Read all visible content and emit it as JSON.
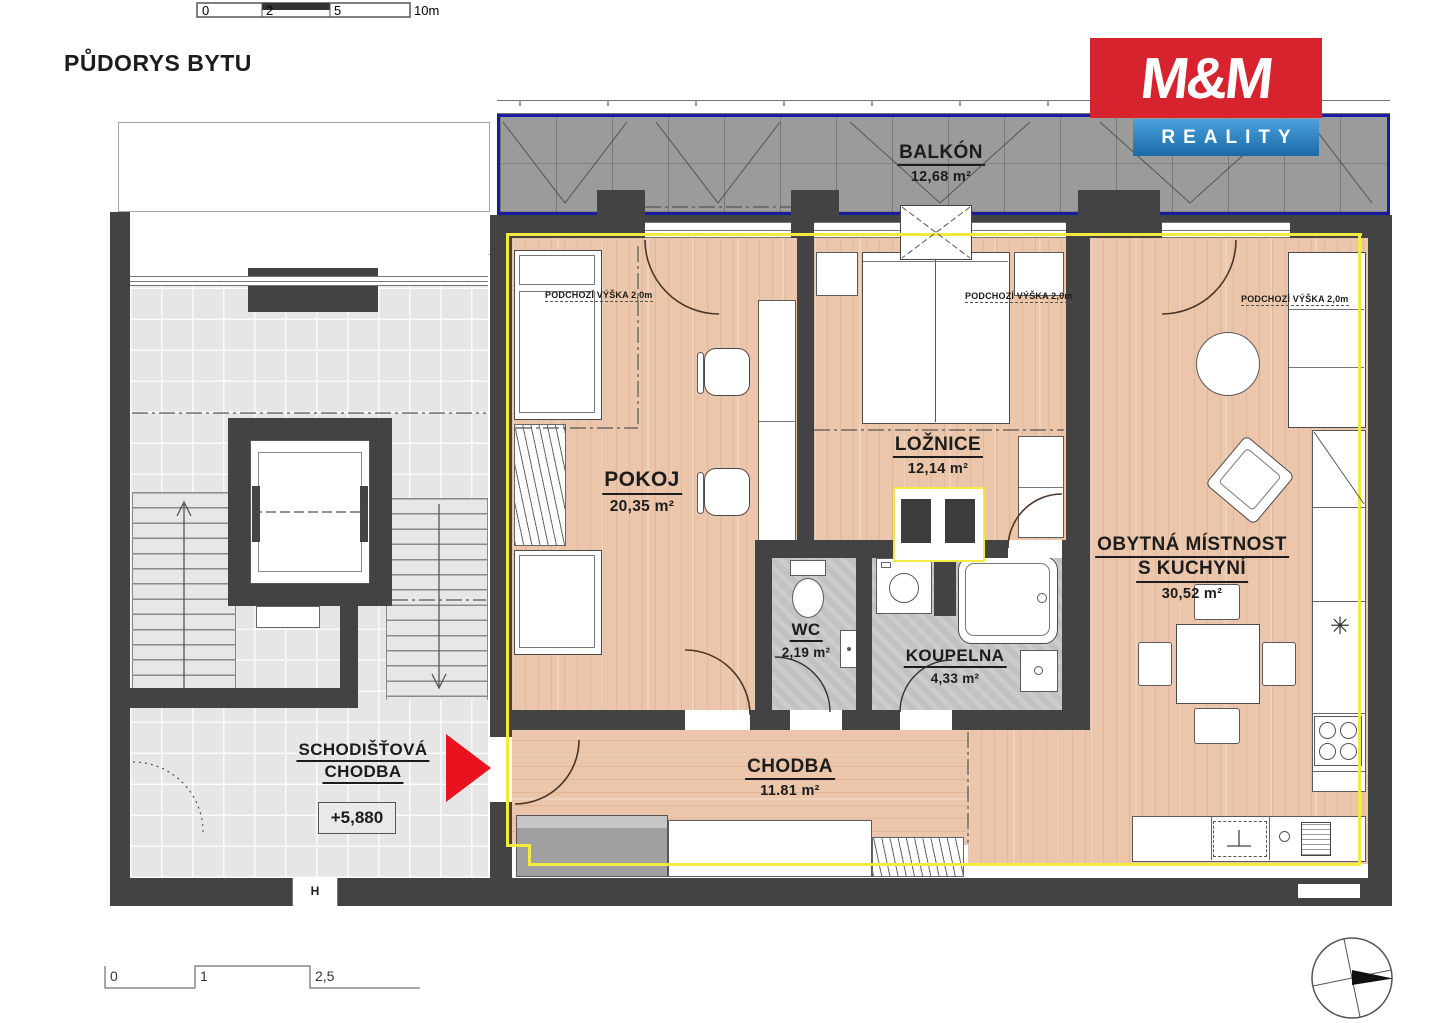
{
  "title": "PŮDORYS BYTU",
  "logo": {
    "mm": "M&M",
    "reality": "REALITY"
  },
  "scale_top": {
    "t0": "0",
    "t1": "2",
    "t2": "5",
    "t3": "10m"
  },
  "scale_bottom": {
    "t0": "0",
    "t1": "1",
    "t2": "2,5"
  },
  "rooms": {
    "balkon": {
      "name": "BALKÓN",
      "area": "12,68 m²"
    },
    "pokoj": {
      "name": "POKOJ",
      "area": "20,35 m²"
    },
    "loznice": {
      "name": "LOŽNICE",
      "area": "12,14 m²"
    },
    "obytna": {
      "name_line1": "OBYTNÁ MÍSTNOST",
      "name_line2": "S KUCHYNÍ",
      "area": "30,52 m²"
    },
    "wc": {
      "name": "WC",
      "area": "2,19 m²"
    },
    "koupelna": {
      "name": "KOUPELNA",
      "area": "4,33 m²"
    },
    "chodba": {
      "name": "CHODBA",
      "area": "11.81 m²"
    },
    "schodistova_chodba": {
      "name_line1": "SCHODIŠŤOVÁ",
      "name_line2": "CHODBA",
      "level": "+5,880"
    }
  },
  "annotations": {
    "headroom": "PODCHOZÍ VÝŠKA 2,0m",
    "door_mark": "H",
    "freezer_mark": "✳"
  },
  "colors": {
    "wall": "#434343",
    "wood_floor": "#ebc6aa",
    "hall_tile": "#e6e6e6",
    "bath_tile": "#c2c2c2",
    "balcony_floor": "#9b9b9b",
    "balcony_border_blue": "#1b1b9e",
    "apartment_boundary_yellow": "#f4ea3d",
    "logo_red": "#d6232e",
    "logo_blue": "#1f74b4",
    "entrance_arrow_red": "#e8131f"
  }
}
